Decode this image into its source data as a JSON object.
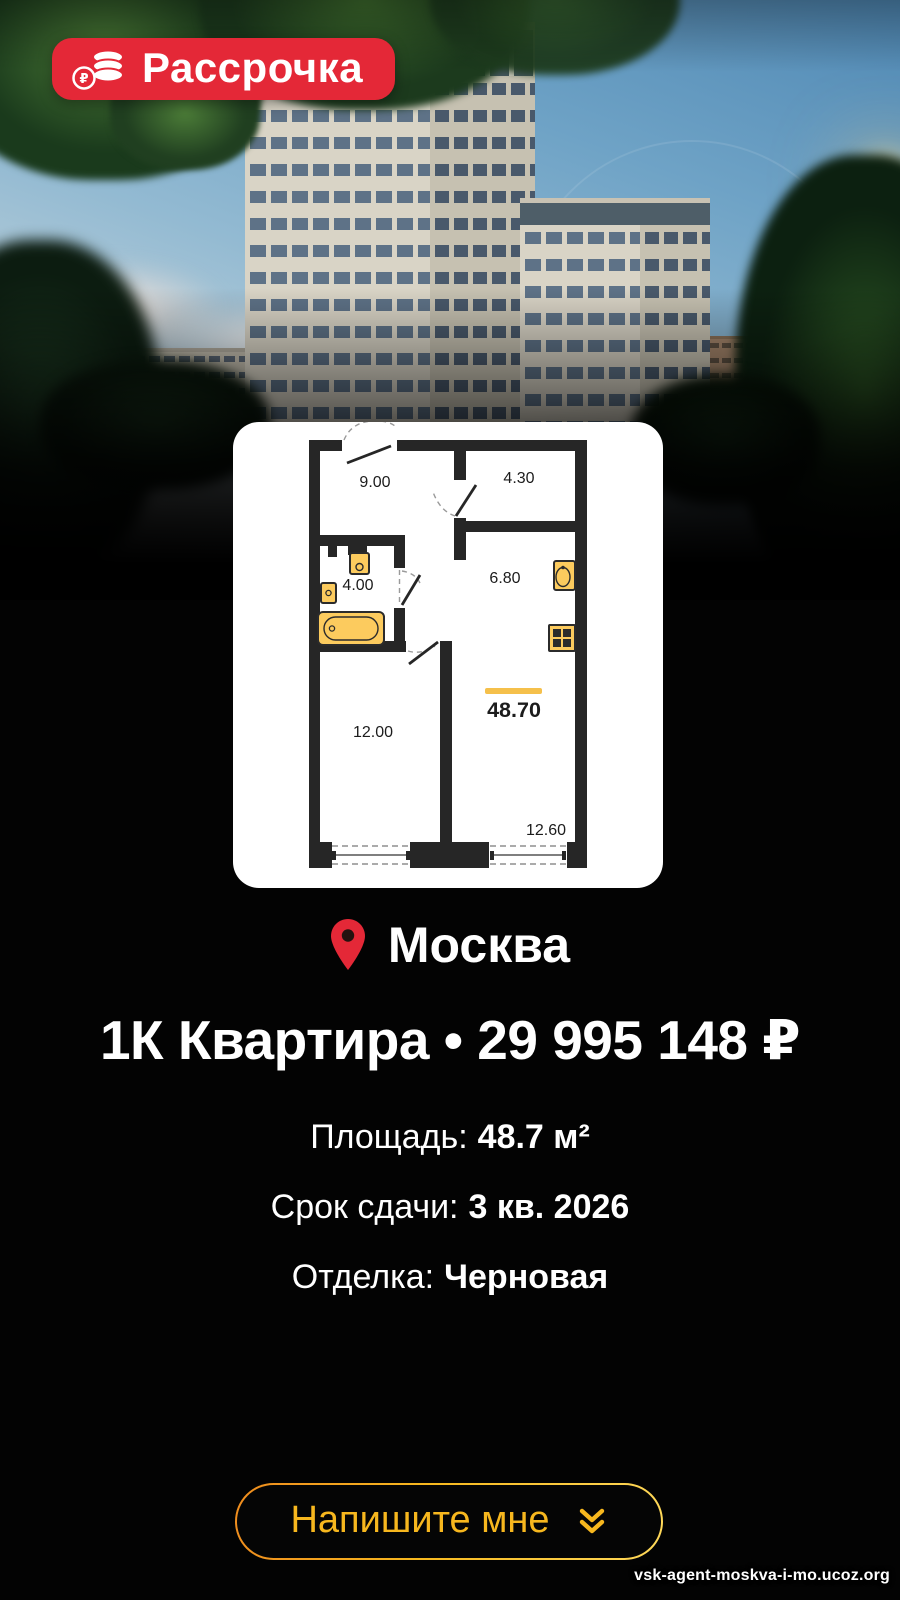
{
  "badge": {
    "label": "Рассрочка",
    "currency_glyph": "₽"
  },
  "floor_plan": {
    "total_area": "48.70",
    "rooms": [
      {
        "name": "hallway",
        "area": "9.00"
      },
      {
        "name": "storage",
        "area": "4.30"
      },
      {
        "name": "bathroom",
        "area": "4.00"
      },
      {
        "name": "corridor-kitchen",
        "area": "6.80"
      },
      {
        "name": "bedroom",
        "area": "12.00"
      },
      {
        "name": "living-room",
        "area": "12.60"
      }
    ]
  },
  "location": {
    "city": "Москва"
  },
  "title": "1К Квартира • 29 995 148 ₽",
  "details": [
    {
      "label": "Площадь:",
      "value": "48.7 м²"
    },
    {
      "label": "Срок сдачи:",
      "value": "3 кв. 2026"
    },
    {
      "label": "Отделка:",
      "value": "Черновая"
    }
  ],
  "cta": {
    "label": "Напишите мне"
  },
  "watermark": "vsk-agent-moskva-i-mo.ucoz.org",
  "colors": {
    "accent_red": "#e42837",
    "accent_gold": "#f7b71e",
    "plan_wall": "#262626",
    "plan_fixture": "#fccb5e",
    "background": "#030303"
  }
}
